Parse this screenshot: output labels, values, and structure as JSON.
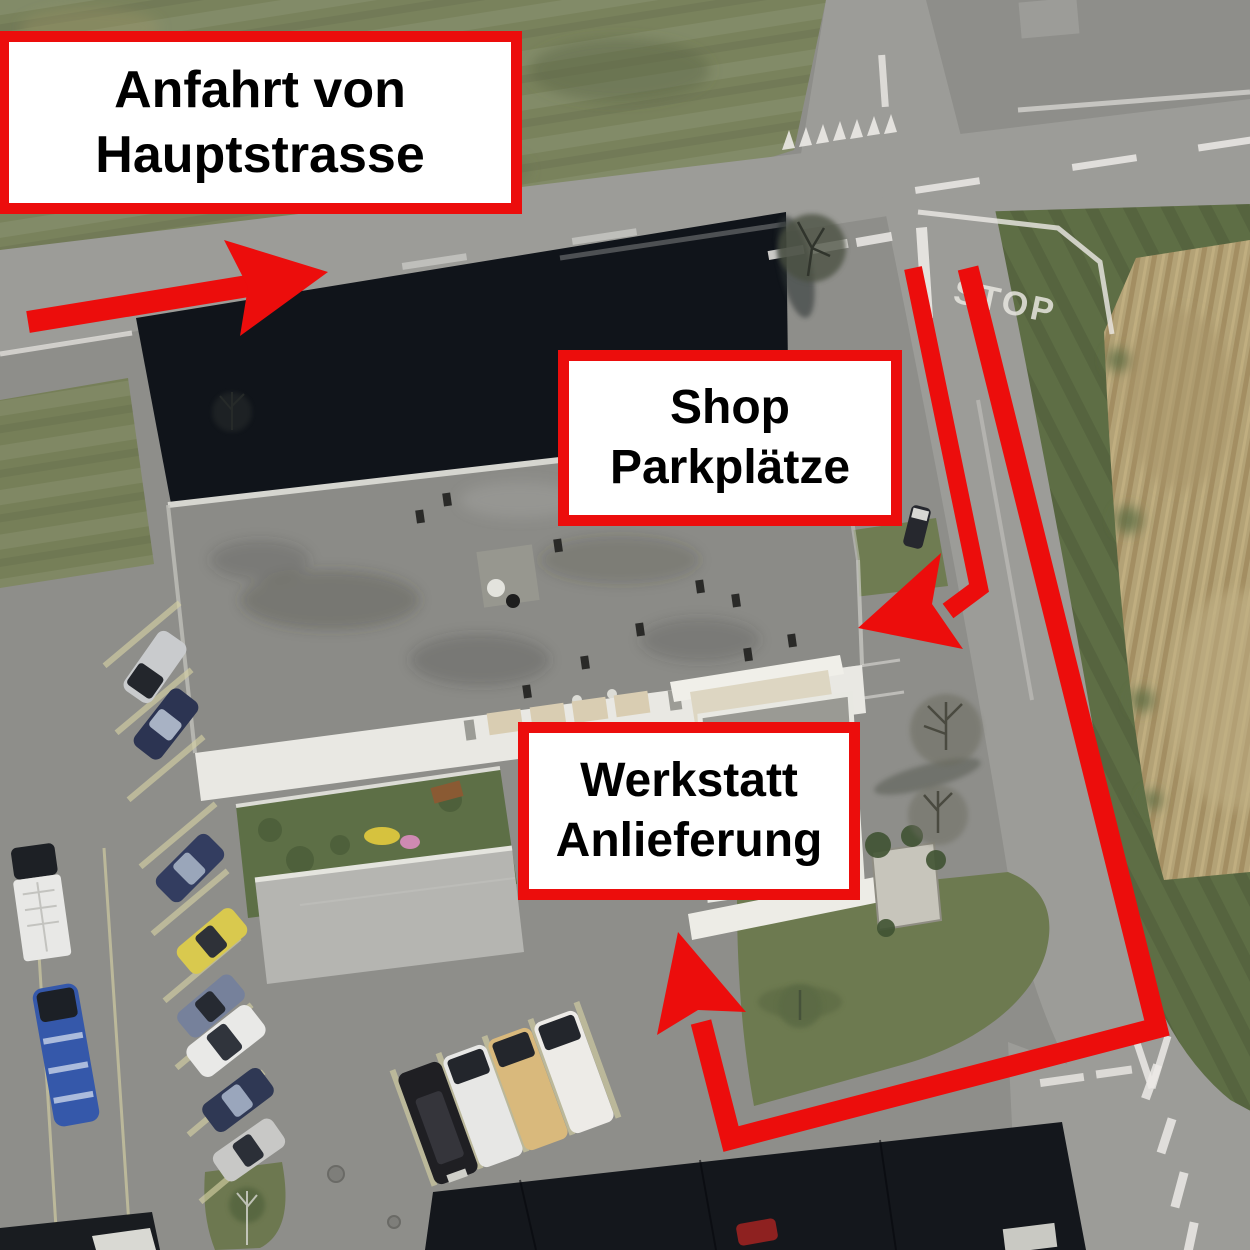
{
  "canvas": {
    "width": 1250,
    "height": 1250
  },
  "colors": {
    "annotation_red": "#ec0d0c",
    "label_bg": "#ffffff",
    "label_text": "#000000",
    "marking_white": "#eceae6"
  },
  "labels": {
    "anfahrt": {
      "line1": "Anfahrt von",
      "line2": "Hauptstrasse"
    },
    "shop": {
      "line1": "Shop",
      "line2": "Parkplätze"
    },
    "werkstatt": {
      "line1": "Werkstatt",
      "line2": "Anlieferung"
    }
  },
  "road_markings": {
    "stop_text": "STOP"
  }
}
